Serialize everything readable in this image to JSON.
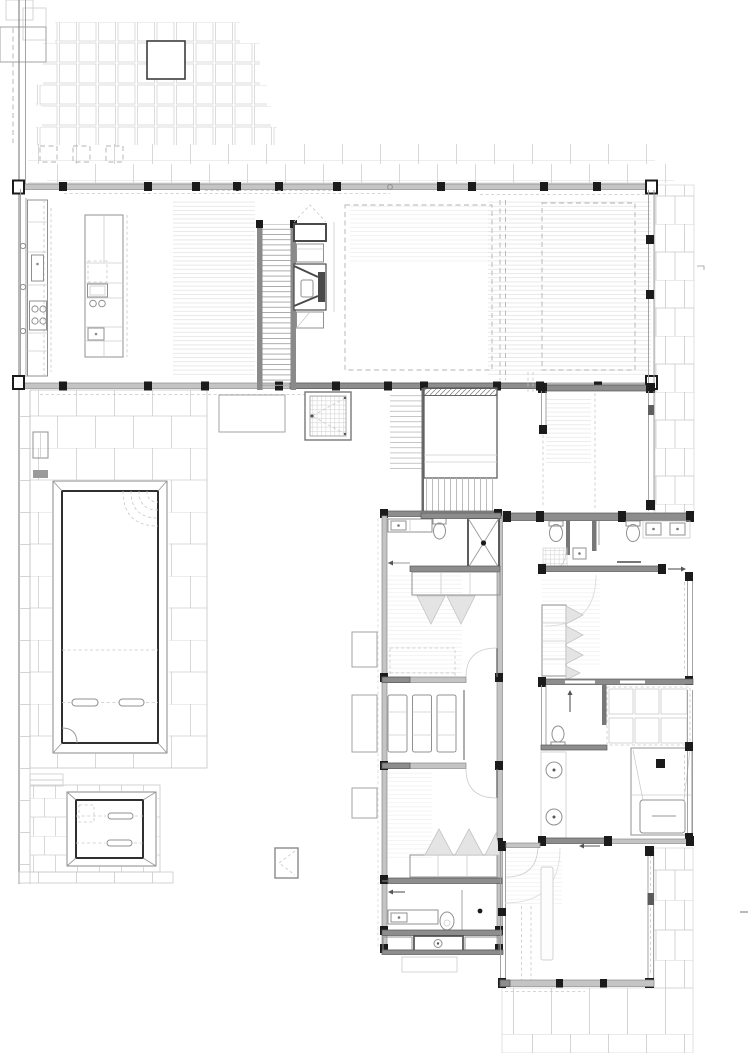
{
  "meta": {
    "title": "Architectural floor plan — ground floor",
    "drawing_type": "floor-plan",
    "canvas": {
      "width": 750,
      "height": 1053,
      "background": "#ffffff"
    }
  },
  "palette": {
    "paper": "#ffffff",
    "wall_dark": "#8d8d8d",
    "window_band": "#c4c4c4",
    "post_black": "#1b1b1b",
    "fixture_line": "#909090",
    "tile_line": "#cccccc",
    "hatch_line": "#e3e3e3",
    "dash_line": "#b3b3b3",
    "pool_edge": "#2f2f2f"
  },
  "features": {
    "terrace": "Front paved terrace with small pavers",
    "planter": "Square planter in terrace paving",
    "tile_band": "Paver band along north facade",
    "boundary_wall": "West boundary wall",
    "kitchen": "Kitchen with wall counter, sink and cooktop",
    "island": "Kitchen island with hob and sink",
    "dining": "Dining area with timber floor",
    "stairs_up": "Main staircase",
    "fireplace": "Double-sided fireplace joinery wall",
    "living": "Living room with dashed ceiling outline",
    "lounge_ne": "North-east lounge room",
    "study": "Study / sitting room",
    "pool": "Swimming pool with steps",
    "pool_deck": "Pool courtyard paving",
    "spa": "Spa plunge pool",
    "skylight": "Hatched rooflight / vent box",
    "service_box": "Small louvred service box on lawn",
    "garden_bed": "Low planter bed",
    "stairwell_down": "Stair flight to lower level",
    "corridor": "Central hallway spine",
    "bedroom1": "Bedroom 1 with ensuite and wardrobe",
    "ensuite1": "Ensuite 1 — vanity, WC and shower",
    "deck_loungers": "Internal deck with three sun loungers",
    "side_tables": "Side tables on lawn edge",
    "bedroom2": "Bedroom 2 with ensuite and wardrobe",
    "ensuite2": "Ensuite 2 — vanity, WC and shower",
    "bathroom_main": "Main bathroom — twin basins and WCs",
    "wc": "Powder room WC",
    "closet": "Linen closet with shelving",
    "bathroom_tub": "Bathroom with sunken bathtub and twin basins",
    "bedroom3": "Bedroom 3 with wardrobe",
    "bedroom4": "Bedroom 4 (south-east)",
    "rug": "Floor rug in bedroom 4",
    "brick_band_east": "Brick paving band along east facade",
    "patio_se": "South-east rear patio paving"
  }
}
